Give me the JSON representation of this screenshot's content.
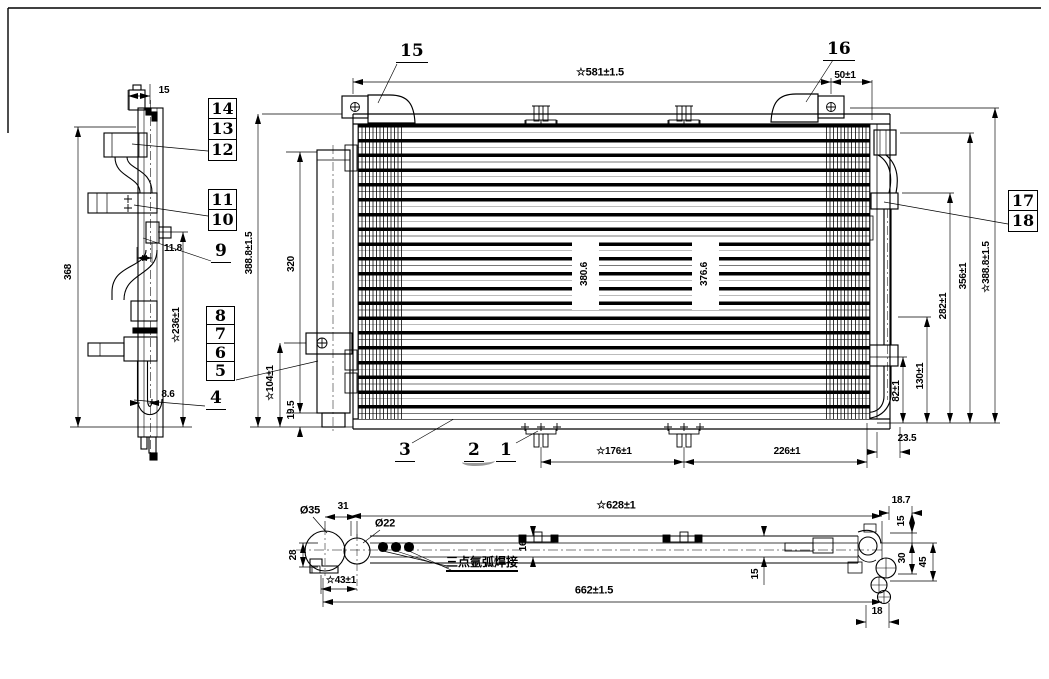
{
  "drawing": {
    "type": "condenser-engineering-drawing",
    "callouts": [
      "1",
      "2",
      "3",
      "4",
      "5",
      "6",
      "7",
      "8",
      "9",
      "10",
      "11",
      "12",
      "13",
      "14",
      "15",
      "16",
      "17",
      "18"
    ],
    "side": {
      "w15": "15",
      "h368": "368",
      "o118": "11.8",
      "s236": "☆236±1",
      "o86": "8.6"
    },
    "front": {
      "w581": "☆581±1.5",
      "w50": "50±1",
      "h3888l": "388.8±1.5",
      "h320": "320",
      "s104": "☆104±1",
      "h195": "19.5",
      "c3806": "380.6",
      "c3766": "376.6",
      "w176": "☆176±1",
      "w226": "226±1",
      "w235": "23.5",
      "h82": "82±1",
      "h130": "130±1",
      "h282": "282±1",
      "h356": "356±1",
      "h3888r": "☆388.8±1.5"
    },
    "bottom": {
      "d35": "Ø35",
      "w31": "31",
      "d22": "Ø22",
      "h28": "28",
      "s43": "☆43±1",
      "weld": "三点氩弧焊接",
      "s628": "☆628±1",
      "t16": "16",
      "t15": "15",
      "w662": "662±1.5",
      "r187": "18.7",
      "r15": "15",
      "r30": "30",
      "r45": "45",
      "r18": "18"
    }
  }
}
